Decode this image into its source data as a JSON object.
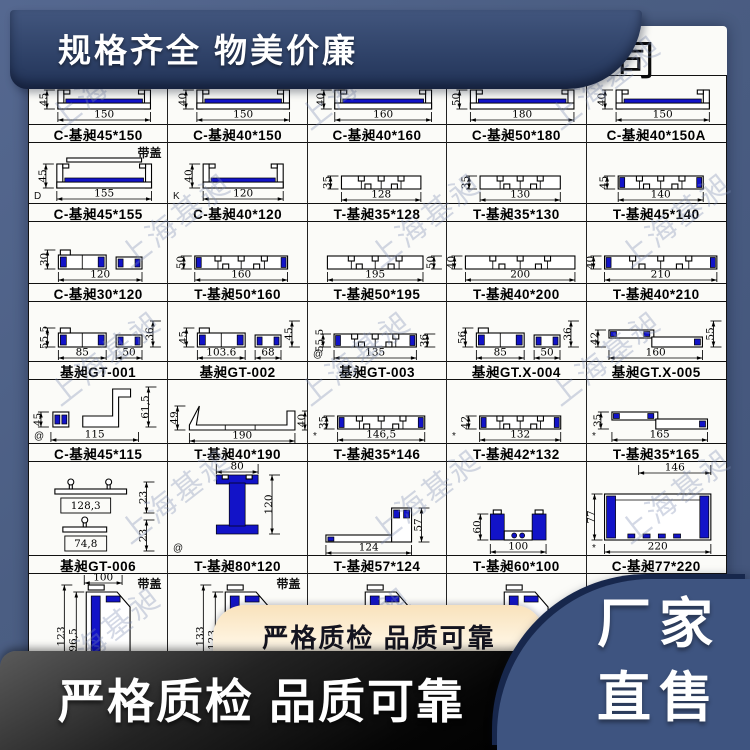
{
  "title": {
    "text": "铝制品有限公司"
  },
  "top_banner": {
    "text": "规格齐全 物美价廉"
  },
  "watermark": {
    "text": "上海基昶"
  },
  "pill": {
    "text": "严格质检 品质可靠"
  },
  "bottom_banner": {
    "text": "严格质检 品质可靠"
  },
  "direct_sale": {
    "line1": "厂家",
    "line2": "直售"
  },
  "colors": {
    "frame_blue": "#4b5e83",
    "banner_navy": "#2e4167",
    "profile_blue": "#1213c8",
    "pill_tan": "#f9e2bb",
    "direct_navy": "#3e5480",
    "banner_black": "#000000"
  },
  "catalog": {
    "rows": [
      {
        "h": 48,
        "cells": [
          {
            "label": "C-基昶45*150",
            "shape": "channel",
            "dims": {
              "b": "150",
              "l": "45"
            }
          },
          {
            "label": "C-基昶40*150",
            "shape": "channel",
            "dims": {
              "b": "150",
              "l": "40"
            }
          },
          {
            "label": "C-基昶40*160",
            "shape": "channel",
            "dims": {
              "b": "160",
              "l": "40"
            }
          },
          {
            "label": "C-基昶50*180",
            "shape": "channel",
            "dims": {
              "b": "180",
              "l": "50"
            }
          },
          {
            "label": "C-基昶40*150A",
            "shape": "channel",
            "dims": {
              "b": "150",
              "l": "40"
            }
          }
        ]
      },
      {
        "h": 60,
        "cells": [
          {
            "label": "C-基昶45*155",
            "shape": "channel",
            "cover": true,
            "note": "带盖",
            "corner": "D",
            "dims": {
              "b": "155",
              "l": "45"
            }
          },
          {
            "label": "C-基昶40*120",
            "shape": "channel",
            "corner": "K",
            "dims": {
              "b": "120",
              "l": "40"
            }
          },
          {
            "label": "T-基昶35*128",
            "shape": "plate",
            "dims": {
              "b": "128",
              "l": "35"
            }
          },
          {
            "label": "T-基昶35*130",
            "shape": "plate",
            "dims": {
              "b": "130",
              "l": "35"
            }
          },
          {
            "label": "T-基昶45*140",
            "shape": "plate_blue",
            "dims": {
              "b": "140",
              "l": "45"
            }
          }
        ]
      },
      {
        "h": 61,
        "cells": [
          {
            "label": "C-基昶30*120",
            "shape": "twopiece",
            "dims": {
              "b": "120",
              "l": "30"
            }
          },
          {
            "label": "T-基昶50*160",
            "shape": "plate_blue",
            "dims": {
              "b": "160",
              "l": "50"
            }
          },
          {
            "label": "T-基昶50*195",
            "shape": "plate",
            "dims": {
              "b": "195",
              "r": "50"
            }
          },
          {
            "label": "T-基昶40*200",
            "shape": "plate",
            "dims": {
              "b": "200",
              "l": "40"
            }
          },
          {
            "label": "T-基昶40*210",
            "shape": "plate_blue",
            "dims": {
              "b": "210",
              "l": "40"
            }
          }
        ]
      },
      {
        "h": 59,
        "cells": [
          {
            "label": "基昶GT-001",
            "shape": "twopiece",
            "dims": {
              "b": "85",
              "b2": "50",
              "l": "55,5",
              "r": "36"
            }
          },
          {
            "label": "基昶GT-002",
            "shape": "twopiece",
            "dims": {
              "b": "103.6",
              "b2": "68",
              "l": "45",
              "r": "45"
            }
          },
          {
            "label": "基昶GT-003",
            "shape": "plate_blue",
            "corner": "@",
            "dims": {
              "b": "135",
              "l": "55,5",
              "r": "36"
            }
          },
          {
            "label": "基昶GT.X-004",
            "shape": "twopiece",
            "dims": {
              "b": "85",
              "b2": "50",
              "l": "56",
              "r": "36"
            }
          },
          {
            "label": "基昶GT.X-005",
            "shape": "zangle",
            "dims": {
              "b": "160",
              "l": "42",
              "r": "55"
            }
          }
        ]
      },
      {
        "h": 63,
        "cells": [
          {
            "label": "C-基昶45*115",
            "shape": "bracket",
            "corner": "@",
            "dims": {
              "b": "115",
              "l": "45",
              "r": "61,5"
            }
          },
          {
            "label": "T-基昶40*190",
            "shape": "tray",
            "dims": {
              "b": "190",
              "l": "49",
              "r": "40"
            }
          },
          {
            "label": "T-基昶35*146",
            "shape": "plate_blue",
            "corner": "*",
            "dims": {
              "b": "146,5",
              "l": "35"
            }
          },
          {
            "label": "T-基昶42*132",
            "shape": "plate_blue",
            "corner": "*",
            "dims": {
              "b": "132",
              "l": "42"
            }
          },
          {
            "label": "T-基昶35*165",
            "shape": "zangle",
            "corner": "*",
            "dims": {
              "b": "165",
              "l": "35"
            }
          }
        ]
      },
      {
        "h": 93,
        "cells": [
          {
            "label": "基昶GT-006",
            "shape": "pair",
            "dims": {
              "b": "128,3",
              "b2": "74,8",
              "r": "23",
              "r2": "23"
            }
          },
          {
            "label": "T-基昶80*120",
            "shape": "ibeam",
            "corner": "@",
            "dims": {
              "t": "80",
              "r": "120"
            }
          },
          {
            "label": "T-基昶57*124",
            "shape": "step",
            "dims": {
              "b": "124",
              "r": "57"
            }
          },
          {
            "label": "T-基昶60*100",
            "shape": "usmall",
            "dims": {
              "b": "100",
              "l": "60"
            }
          },
          {
            "label": "C-基昶77*220",
            "shape": "bigbox",
            "corner": "*",
            "dims": {
              "t": "146",
              "l": "77",
              "b": "220"
            }
          }
        ]
      },
      {
        "h": 122,
        "nolabel": true,
        "cells": [
          {
            "label": "",
            "shape": "tall",
            "note": "带盖",
            "dims": {
              "t": "100",
              "l": "123",
              "l2": "96,5"
            }
          },
          {
            "label": "",
            "shape": "tall",
            "note": "带盖",
            "dims": {
              "l": "133",
              "l2": "123"
            }
          },
          {
            "label": "",
            "shape": "tall_partial",
            "dims": {}
          },
          {
            "label": "",
            "shape": "tall_partial",
            "dims": {}
          },
          {
            "label": "",
            "shape": "none",
            "dims": {}
          }
        ]
      }
    ]
  }
}
